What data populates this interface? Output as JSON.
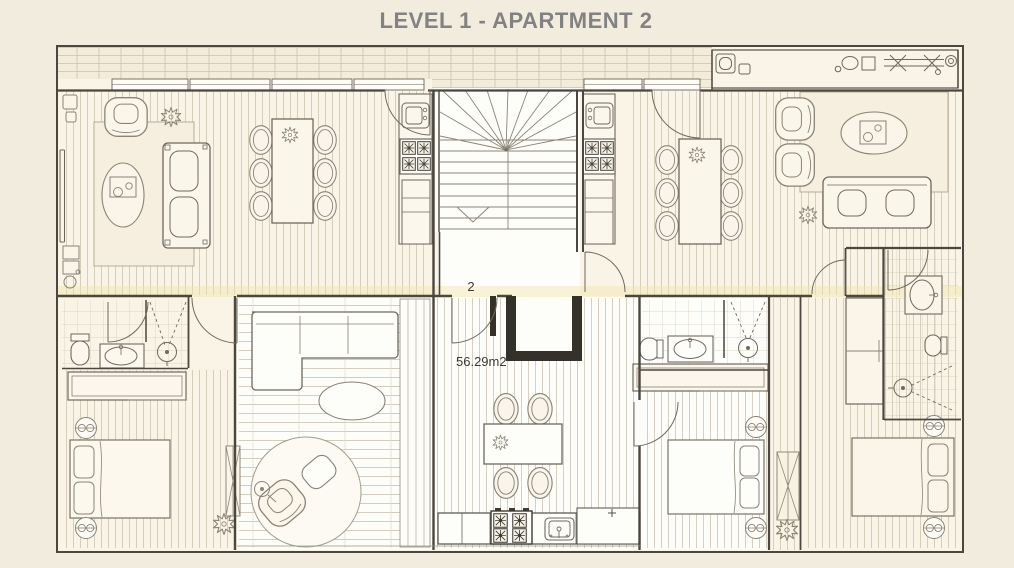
{
  "title": "LEVEL 1 - APARTMENT 2",
  "apartment": {
    "number": "2",
    "area": "56.29m2"
  },
  "colors": {
    "background": "#f1ecdd",
    "paper": "#f9f4e6",
    "unit_highlight": "#fdfdfa",
    "wall": "#4b463e",
    "wall_heavy": "#34302a",
    "furniture_line": "#8a8376",
    "fixture_line": "#6f695e",
    "floor_pattern": "#c6bda9",
    "rug": "#f6efdf",
    "title_text": "#828282",
    "label_text": "#3c3a35",
    "highlight_band": "#f1e5ae"
  },
  "icons": [
    "staircase-icon",
    "door-swing-icon",
    "window-icon",
    "sofa-icon",
    "corner-sofa-icon",
    "armchair-icon",
    "dining-table-icon",
    "dining-chair-icon",
    "coffee-table-icon",
    "rug-icon",
    "round-rug-icon",
    "bed-icon",
    "pillow-icon",
    "bedside-lamp-icon",
    "wardrobe-icon",
    "toilet-icon",
    "bathroom-sink-icon",
    "shower-icon",
    "stove-burner-icon",
    "kitchen-sink-icon",
    "kitchen-counter-icon",
    "fridge-icon",
    "plant-icon",
    "planter-icon",
    "washing-machine-icon",
    "ironing-board-icon",
    "floor-lamp-icon",
    "ottoman-icon"
  ]
}
